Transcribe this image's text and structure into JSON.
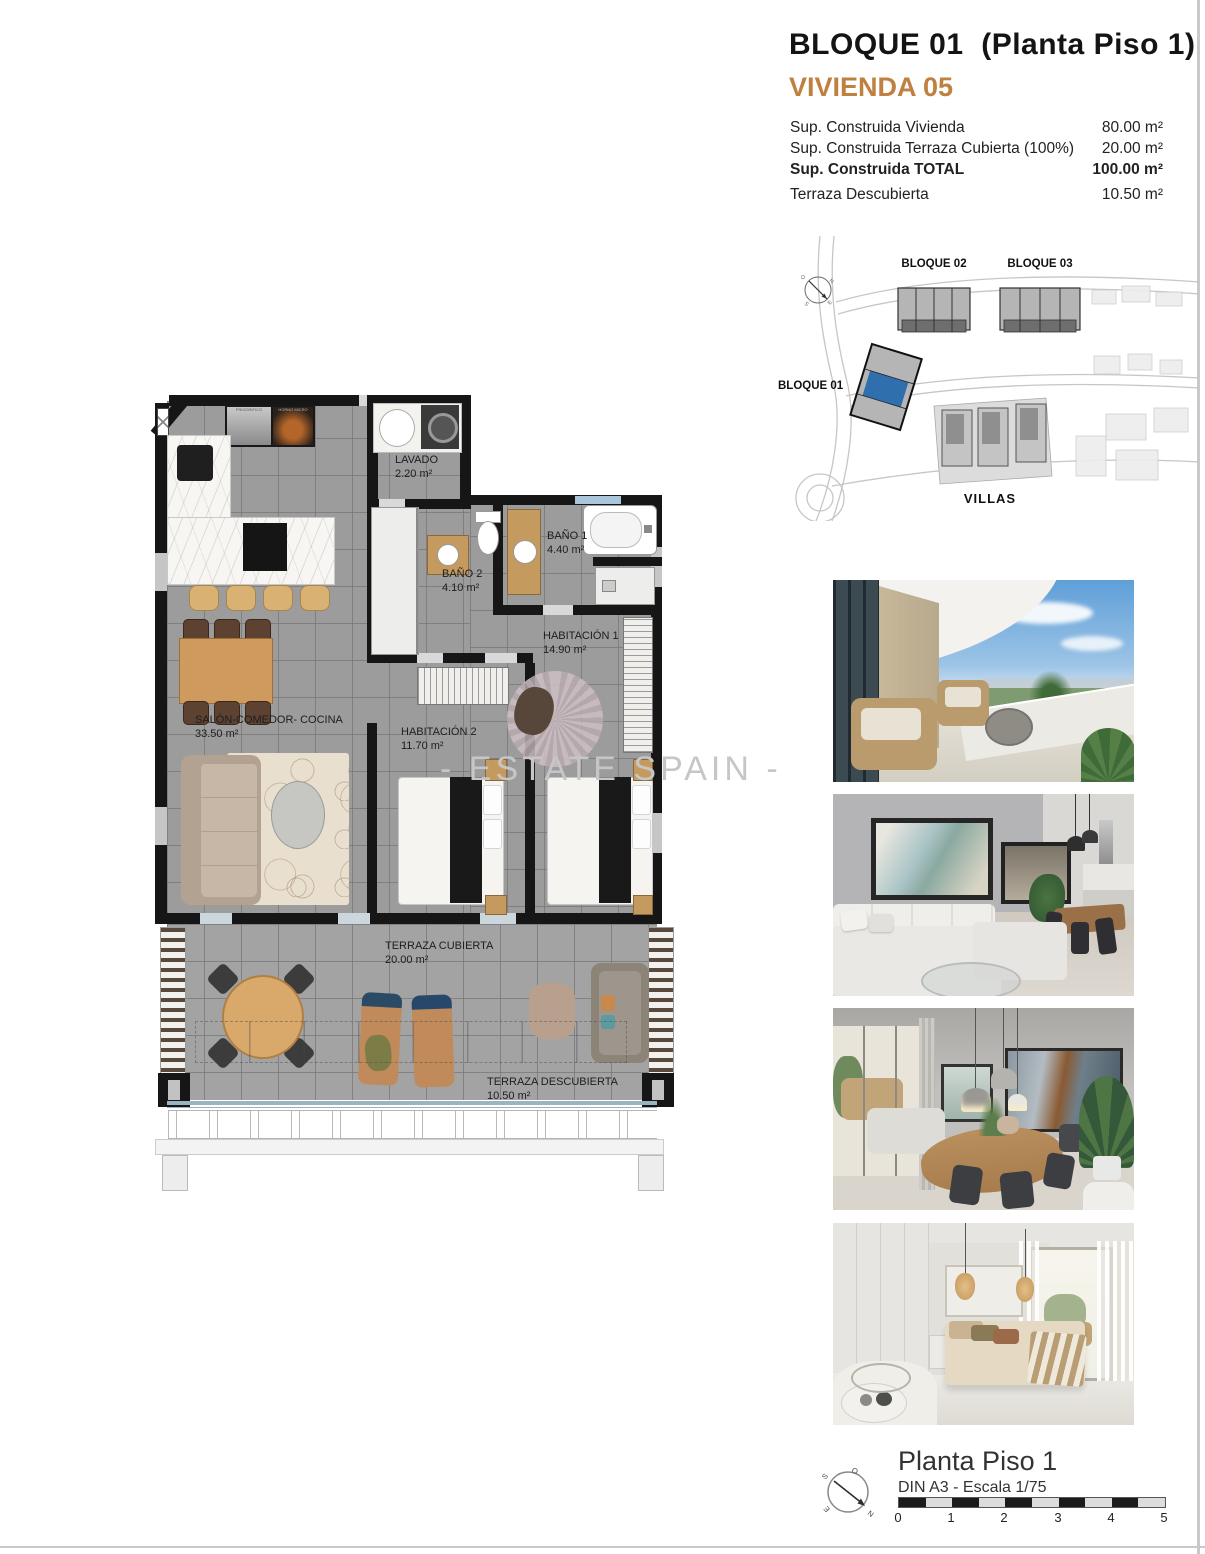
{
  "header": {
    "title": "BLOQUE 01  (Planta Piso 1)",
    "subtitle": "VIVIENDA 05",
    "specs": [
      {
        "label": "Sup. Construida Vivienda",
        "value": "80.00 m²"
      },
      {
        "label": "Sup. Construida Terraza Cubierta (100%)",
        "value": "20.00 m²"
      },
      {
        "label": "Sup. Construida TOTAL",
        "value": "100.00 m²"
      },
      {
        "label": "Terraza Descubierta",
        "value": "10.50 m²"
      }
    ]
  },
  "site_plan": {
    "labels": {
      "bloque01": "BLOQUE 01",
      "bloque02": "BLOQUE 02",
      "bloque03": "BLOQUE 03",
      "villas": "VILLAS"
    },
    "highlight_color": "#2f6fae"
  },
  "floor_plan": {
    "rooms": [
      {
        "name": "LAVADO",
        "area": "2.20 m²"
      },
      {
        "name": "BAÑO 2",
        "area": "4.10 m²"
      },
      {
        "name": "BAÑO 1",
        "area": "4.40 m²"
      },
      {
        "name": "HABITACIÓN 1",
        "area": "14.90 m²"
      },
      {
        "name": "HABITACIÓN 2",
        "area": "11.70 m²"
      },
      {
        "name": "SALÓN-COMEDOR- COCINA",
        "area": "33.50 m²"
      },
      {
        "name": "TERRAZA CUBIERTA",
        "area": "20.00 m²"
      },
      {
        "name": "TERRAZA DESCUBIERTA",
        "area": "10.50 m²"
      }
    ],
    "appliances": {
      "fridge": "FRIGORIFICO",
      "oven": "HORNO MICRO"
    },
    "colors": {
      "wall": "#161616",
      "floor": "#9c9c9c",
      "wood": "#c59a5f"
    }
  },
  "watermark": "- ESTATE SPAIN -",
  "compass": {
    "n": "N",
    "s": "S",
    "e": "E",
    "o": "O"
  },
  "photos": [
    {
      "name": "terrace-render"
    },
    {
      "name": "living-room-render"
    },
    {
      "name": "dining-room-render"
    },
    {
      "name": "bedroom-render"
    }
  ],
  "footer": {
    "title": "Planta Piso 1",
    "scale_note": "DIN A3 - Escala 1/75",
    "scale_ticks": [
      "0",
      "1",
      "2",
      "3",
      "4",
      "5"
    ]
  }
}
